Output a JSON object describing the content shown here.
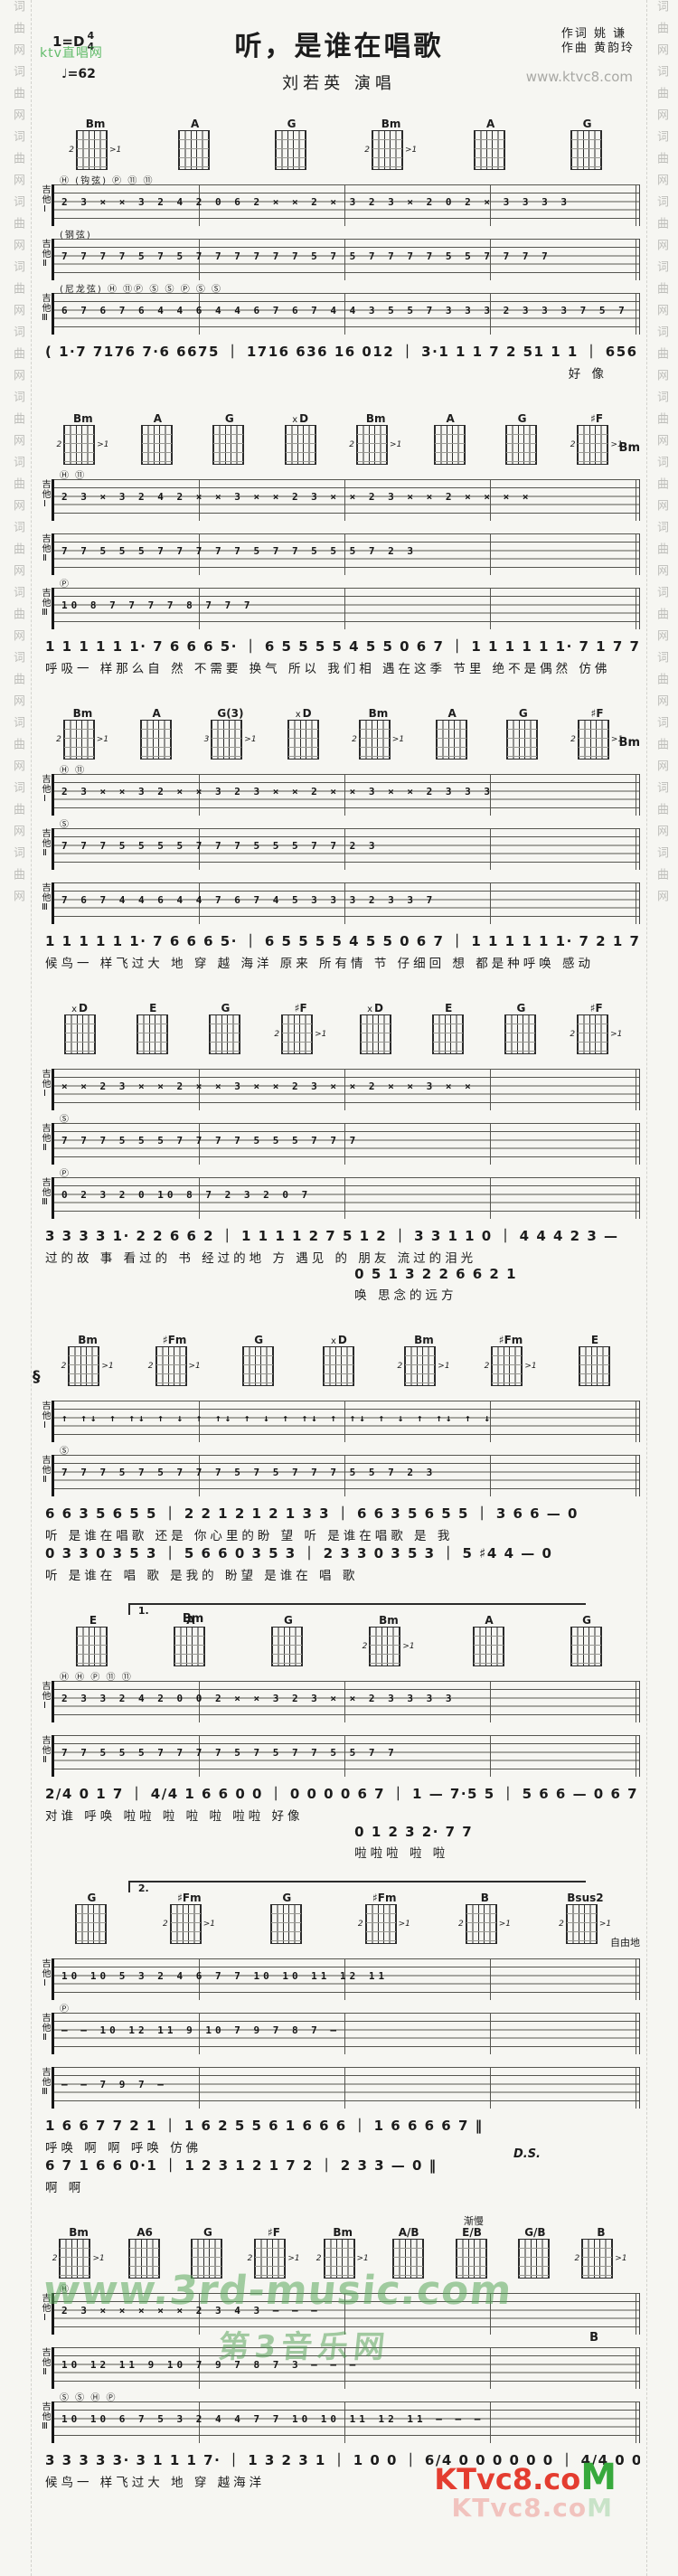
{
  "page": {
    "side_watermark": "词曲网词曲网词曲网词曲网词曲网词曲网词曲网词曲网词曲网词曲网词曲网词曲网词曲网词曲网"
  },
  "header": {
    "key": "1=D",
    "time_top": "4",
    "time_bottom": "4",
    "tempo": "♩=62",
    "title": "听，是谁在唱歌",
    "lyricist": "作词 姚  谦",
    "composer": "作曲 黄韵玲",
    "site_watermark": "www.ktvc8.com",
    "ktv_watermark": "ktv直唱网",
    "artist": "刘若英    演唱"
  },
  "systems": [
    {
      "chords": [
        {
          "left": "2",
          "name": "Bm",
          "post": ">1"
        },
        {
          "name": "A"
        },
        {
          "name": "G"
        },
        {
          "left": "2",
          "name": "Bm",
          "post": ">1"
        },
        {
          "name": "A"
        },
        {
          "name": "G"
        }
      ],
      "staves": [
        {
          "label": "吉他Ⅰ",
          "note": "Ⓗ (钩弦) Ⓟ        ⑪                    ⑪",
          "tab": "2 3 ×  × 3 2  4 2  0 6 2  ×  ×  2 ×  3  2 3  ×  2  0 2  ×  3 3 3 3"
        },
        {
          "label": "吉他Ⅱ",
          "note": "(钢弦)",
          "tab": "7 7 7  7 5  7 5  7 7  7 7  7  7 5  7 5  7 7  7 7  5 5  7 7  7 7"
        },
        {
          "label": "吉他Ⅲ",
          "note": "(尼龙弦)  Ⓗ  ⑪Ⓟ  Ⓢ  Ⓢ  Ⓟ      Ⓢ          Ⓢ",
          "tab": "6 7 6 7 6 4  4 6 4 4 6  7 6 7 4  4  3 5  5 7 3 3 3  2  3 3 3  7 5 7"
        }
      ],
      "vocal": {
        "numbers": "( 1·7 7176  7·6 6675 ｜ 1716 636 16 012 ｜ 3·1 1 1 7 2 51 1 1 ｜ 656 3 3 — ) 0 6 7",
        "lyrics": "好 像"
      },
      "marks": {}
    },
    {
      "chords": [
        {
          "left": "2",
          "name": "Bm",
          "post": ">1"
        },
        {
          "name": "A"
        },
        {
          "name": "G"
        },
        {
          "pre": "x",
          "name": "D"
        },
        {
          "left": "2",
          "name": "Bm",
          "post": ">1"
        },
        {
          "name": "A"
        },
        {
          "name": "G"
        },
        {
          "left": "2",
          "name": "♯F",
          "post": ">1"
        }
      ],
      "staves": [
        {
          "label": "吉他Ⅰ",
          "note": "Ⓗ                         ⑪",
          "tab": "2 3 ×  3 2  4 2  × ×  3  × ×  2  3  × ×  2 3  × ×  2  × ×  × ×"
        },
        {
          "label": "吉他Ⅱ",
          "note": "",
          "tab": "7  7 5  5 5  7  7 7  7  7 5  7 7  5 5 5  7  2 3"
        },
        {
          "label": "吉他Ⅲ",
          "note": "Ⓟ",
          "tab": "10 8 7  7  7  7  8 7  7  7"
        }
      ],
      "vocal": {
        "numbers": "1 1 1 1 1 1·  7 6 6 6 5· ｜ 6 5 5 5 5 4 5 5  0 6 7 ｜ 1 1 1 1 1 1·  7 1 7 7 5 5 ｜ 6 1 7 1 6  0 6 7",
        "lyrics": "呼吸一  样那么自  然  不需要  换气    所以  我们相  遇在这季  节里  绝不是偶然  仿佛"
      },
      "marks": {
        "extra_chord": "Bm"
      }
    },
    {
      "chords": [
        {
          "left": "2",
          "name": "Bm",
          "post": ">1"
        },
        {
          "name": "A"
        },
        {
          "left": "3",
          "name": "G(3)",
          "post": ">1"
        },
        {
          "pre": "x",
          "name": "D"
        },
        {
          "left": "2",
          "name": "Bm",
          "post": ">1"
        },
        {
          "name": "A"
        },
        {
          "name": "G"
        },
        {
          "left": "2",
          "name": "♯F",
          "post": ">1"
        }
      ],
      "staves": [
        {
          "label": "吉他Ⅰ",
          "note": "Ⓗ                         ⑪",
          "tab": "2 3 ×  × 3 2  × ×  3  2 3  ×  ×  2  × ×  3  × ×  2  3 3 3"
        },
        {
          "label": "吉他Ⅱ",
          "note": "Ⓢ",
          "tab": "7  7 7  5  5 5 5  7  7 7  5  5 5  7  7  2 3"
        },
        {
          "label": "吉他Ⅲ",
          "note": "",
          "tab": "7 6 7 4  4 6  4 4  7 6 7 4  5 3  3 3  2 3  3 7"
        }
      ],
      "vocal": {
        "numbers": "1 1 1 1 1 1·  7 6 6 6 5· ｜ 6 5 5 5 5 4 5 5  0 6 7 ｜ 1 1 1 1 1 1·  7 2 1 7 7 5· ｜ 6 1 7 1 6  0 1 2",
        "lyrics": "候鸟一  样飞过大  地  穿  越  海洋    原来  所有情  节  仔细回  想  都是种呼唤  感动"
      },
      "marks": {
        "extra_chord": "Bm"
      }
    },
    {
      "chords": [
        {
          "pre": "x",
          "name": "D"
        },
        {
          "name": "E"
        },
        {
          "name": "G"
        },
        {
          "left": "2",
          "name": "♯F",
          "post": ">1"
        },
        {
          "pre": "x",
          "name": "D"
        },
        {
          "name": "E"
        },
        {
          "name": "G"
        },
        {
          "left": "2",
          "name": "♯F",
          "post": ">1"
        }
      ],
      "staves": [
        {
          "label": "吉他Ⅰ",
          "note": "",
          "tab": "× ×  2 3  × ×  2  × ×  3  × ×  2 3  × ×  2  × ×  3  × ×"
        },
        {
          "label": "吉他Ⅱ",
          "note": "Ⓢ",
          "tab": "7 7  7 5  5  5 7  7  7 7  5  5 5  7 7  7"
        },
        {
          "label": "吉他Ⅲ",
          "note": "Ⓟ",
          "tab": "0  2 3  2  0  10 8 7  2 3  2  0  7"
        }
      ],
      "vocal": {
        "numbers": "3 3 3 3 1·  2 2 6 6 2 ｜ 1 1 1 1 2 7 5  1 2 ｜ 3  3 1 1  0 ｜ 4 4 4 2 3  —",
        "lyrics": "过的故  事  看过的  书  经过的地  方  遇见  的  朋友        流过的泪光",
        "numbers2": "0 5 1 3  2 2 6 6 2 1",
        "lyrics2": "唤   思念的远方"
      },
      "marks": {}
    },
    {
      "chords": [
        {
          "left": "2",
          "name": "Bm",
          "post": ">1"
        },
        {
          "left": "2",
          "name": "♯Fm",
          "post": ">1"
        },
        {
          "name": "G"
        },
        {
          "pre": "x",
          "name": "D"
        },
        {
          "left": "2",
          "name": "Bm",
          "post": ">1"
        },
        {
          "left": "2",
          "name": "♯Fm",
          "post": ">1"
        },
        {
          "name": "E"
        }
      ],
      "staves": [
        {
          "label": "吉他Ⅰ",
          "note": "",
          "tab": "↑ ↑↓ ↑ ↑↓  ↑ ↓  ↑ ↑↓ ↑  ↓  ↑ ↑↓ ↑ ↑↓  ↑ ↓  ↑ ↑↓ ↑  ↓"
        },
        {
          "label": "吉他Ⅱ",
          "note": "Ⓢ",
          "tab": "7  7 7  5  7 5  7  7 7  5  7 5  7  7 7  5 5  7  2 3"
        }
      ],
      "vocal": {
        "numbers": "6  6 3 5 6 5 5 ｜ 2 2  1 2 1  2 1  3 3 ｜ 6  6 3 5 6 5 5 ｜ 3 6 6  —  0",
        "lyrics": "听   是谁在唱歌     还是  你心里的盼  望     听   是谁在唱歌     是  我",
        "numbers2": "0 3 3  0 3 5 3 ｜ 5 6 6  0 3 5 3 ｜ 2 3 3  0 3 5 3 ｜ 5 ♯4 4  —  0",
        "lyrics2": "听    是谁在  唱  歌     是我的  盼望     是谁在  唱  歌"
      },
      "marks": {
        "segno": "§"
      }
    },
    {
      "chords": [
        {
          "name": "E"
        },
        {
          "name": "A"
        },
        {
          "name": "G"
        },
        {
          "left": "2",
          "name": "Bm",
          "post": ">1"
        },
        {
          "name": "A"
        },
        {
          "name": "G"
        }
      ],
      "staves": [
        {
          "label": "吉他Ⅰ",
          "note": "Ⓗ Ⓗ   Ⓟ   ⑪           ⑪",
          "tab": "2 3  3 2  4 2  0 0 2  × ×  3  2 3  × ×  2  3 3 3  3"
        },
        {
          "label": "吉他Ⅱ",
          "note": "",
          "tab": "7  7 5  5 5  7  7 7  7 5  7 5  7 7  5 5  7 7"
        }
      ],
      "vocal": {
        "numbers": "2/4 0 1 7 ｜ 4/4 1  6 6 0 0 ｜ 0 0 0  0 6 7 ｜ 1  —  7·5 5 ｜ 5 6 6  —  0 6 7 :‖",
        "lyrics": "对谁    呼唤            啦啦  啦     啦  啦    啦啦      好像",
        "numbers2": "0 1 2 3  2·  7  7",
        "lyrics2": "啦啦啦 啦  啦"
      },
      "marks": {
        "volta": "1.",
        "extra_chord": "Bm"
      }
    },
    {
      "chords": [
        {
          "name": "G"
        },
        {
          "left": "2",
          "name": "♯Fm",
          "post": ">1"
        },
        {
          "name": "G"
        },
        {
          "left": "2",
          "name": "♯Fm",
          "post": ">1"
        },
        {
          "left": "2",
          "name": "B",
          "post": ">1"
        },
        {
          "left": "2",
          "name": "Bsus2",
          "post": ">1"
        }
      ],
      "staves": [
        {
          "label": "吉他Ⅰ",
          "note": "",
          "tab": "10 10  5 3 2  4  6 7  7 10 10  11 12 11"
        },
        {
          "label": "吉他Ⅱ",
          "note": "Ⓟ",
          "tab": "—  —  10 12 11  9 10  7 9  7 8  7  —"
        },
        {
          "label": "吉他Ⅲ",
          "note": "",
          "tab": "—   —   7   9   7   —"
        }
      ],
      "vocal": {
        "numbers": "1 6 6  7 7 2 1 ｜ 1  6  2 5  5 6 1 6 6 6 ｜ 1 6 6 6  6 7 ‖",
        "lyrics": "呼唤    啊              啊              呼唤      仿佛",
        "numbers2": "6 7 1 6 6  0·1 ｜ 1 2 3 1  2 1  7 2 ｜ 2 3 3  —  0 ‖",
        "lyrics2": "啊          啊",
        "end_mark": "D.S."
      },
      "marks": {
        "volta": "2.",
        "tempo_note": "自由地"
      }
    },
    {
      "chords": [
        {
          "left": "2",
          "name": "Bm",
          "post": ">1"
        },
        {
          "name": "A6"
        },
        {
          "name": "G"
        },
        {
          "left": "2",
          "name": "♯F",
          "post": ">1"
        },
        {
          "left": "2",
          "name": "Bm",
          "post": ">1"
        },
        {
          "name": "A/B"
        },
        {
          "name": "E/B"
        },
        {
          "name": "G/B"
        },
        {
          "left": "2",
          "name": "B",
          "post": ">1"
        }
      ],
      "staves": [
        {
          "label": "吉他Ⅰ",
          "note": "Ⓗ",
          "tab": "2 3  ×  ×  ×  × ×  2  3 4  3  —  —  —"
        },
        {
          "label": "吉他Ⅱ",
          "note": "",
          "tab": "10  12 11  9  10  7 9  7  8 7  3  —  —  —"
        },
        {
          "label": "吉他Ⅲ",
          "note": "Ⓢ        Ⓢ      Ⓗ Ⓟ",
          "tab": "10 10  6 7  5 3 2  4  4 7  7 10 10  11 12 11  —  —  —"
        }
      ],
      "vocal": {
        "numbers": "3 3 3  3 3·  3 1 1 1 7· ｜ 1 3 2 3 1 ｜ 1  0  0 ｜ 6/4 0 0 0 0 0 0 ｜ 4/4 0 0 0 0 ‖",
        "lyrics": "候鸟一  样飞过大  地  穿  越海洋"
      },
      "marks": {
        "rall": "渐慢",
        "extra_chord": "B"
      }
    }
  ],
  "watermarks": {
    "green_url": "www.3rd-music.com",
    "green_name": "第3音乐网",
    "logo_main": "KTvc8",
    "logo_dot": ".co",
    "logo_m": "M",
    "logo_echo": "KTvc8.co",
    "logo_echo_m": "M"
  }
}
